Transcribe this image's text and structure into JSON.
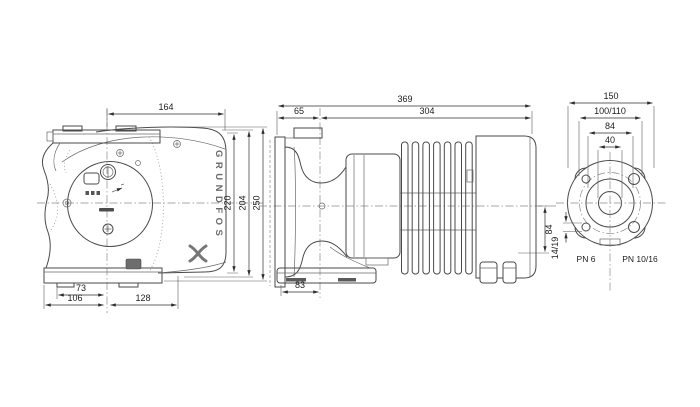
{
  "drawing": {
    "brand": "GRUNDFOS",
    "front_view": {
      "dim_top_width": "164",
      "dim_height_inner": "220",
      "dim_height_mid": "204",
      "dim_height_outer": "250",
      "dim_foot_inner": "73",
      "dim_foot_left": "106",
      "dim_foot_right": "128"
    },
    "side_view": {
      "dim_overall_length": "369",
      "dim_flange_to_axis": "65",
      "dim_axis_to_end": "304",
      "dim_foot": "83",
      "dim_axis_to_bottom": "84"
    },
    "flange_view": {
      "dim_outer_diameter": "150",
      "dim_bolt_circle": "100/110",
      "dim_port_diameter": "84",
      "dim_bore": "40",
      "dim_hole_diameters": "14/19",
      "label_pn_left": "PN 6",
      "label_pn_right": "PN 10/16"
    }
  }
}
